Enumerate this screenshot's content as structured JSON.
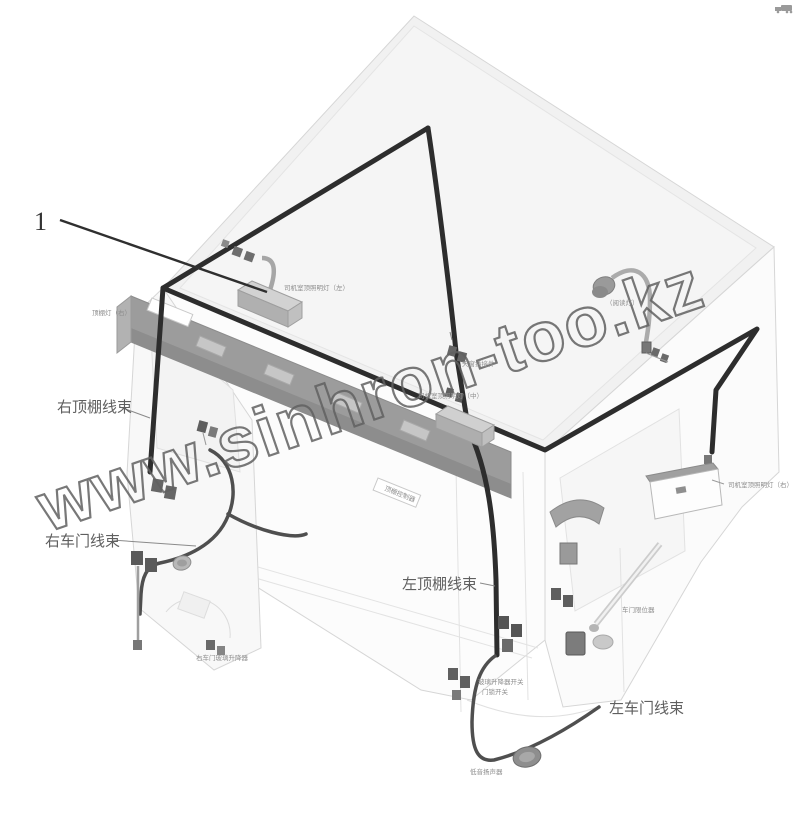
{
  "page": {
    "background": "#ffffff"
  },
  "callout": {
    "number": "1"
  },
  "watermark": {
    "text": "www.sinhron-too.kz"
  },
  "labels": {
    "right_roof_harness": "右顶棚线束",
    "right_door_harness": "右车门线束",
    "left_roof_harness": "左顶棚线束",
    "left_door_harness": "左车门线束"
  },
  "tiny_labels": {
    "cab_lamp_left": "司机室顶照明灯（左）",
    "roof_lamp_right": "顶棚灯（右）",
    "reading_lamp": "（阅读灯）",
    "cab_lamp_right": "司机室顶照明灯（右）",
    "sunroof_connector": "天窗插接件",
    "cab_lamp_middle": "司机室顶照明灯（中）",
    "console_plate": "顶棚控制器",
    "door_stopper": "车门限位器",
    "window_regulator_switch": "玻璃升降器开关",
    "door_lock_switch": "门锁开关",
    "woofer": "低音扬声器",
    "door_module": "右车门玻璃升降器"
  },
  "colors": {
    "harness_main": "#2d2d2d",
    "harness_door": "#4f4f4f",
    "cab_outline": "#d6d6d6",
    "console": "#9c9c9c",
    "label_text": "#5f5f5f",
    "watermark_stroke": "#616161"
  }
}
